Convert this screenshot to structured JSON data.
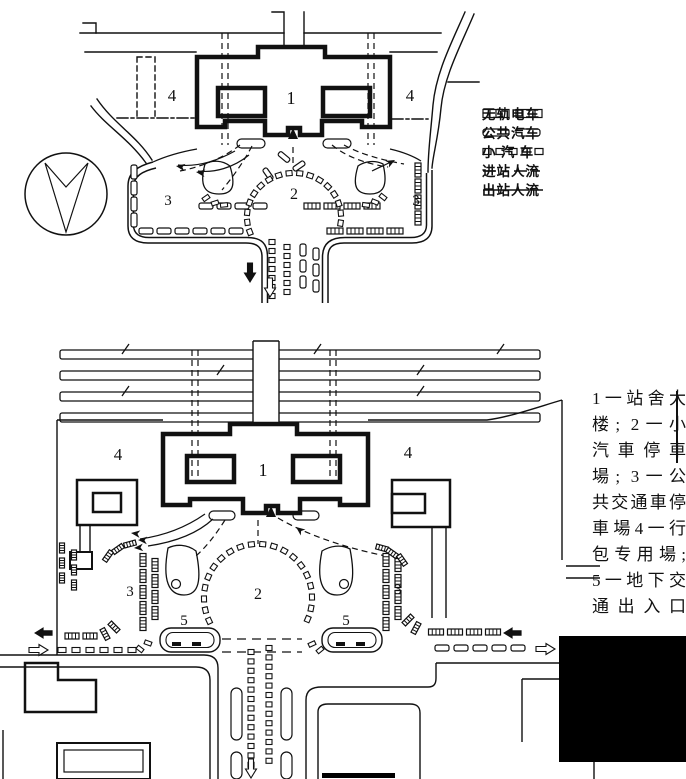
{
  "figure": {
    "type": "railway station forecourt site plans",
    "legend": {
      "items": [
        {
          "icon": "trolleybus-symbol",
          "label": "无轨电车"
        },
        {
          "icon": "bus-symbol",
          "label": "公共汽车"
        },
        {
          "icon": "car-symbol",
          "label": "小 汽 车"
        },
        {
          "icon": "dashed-flow-symbol",
          "label": "进站人流"
        },
        {
          "icon": "solid-flow-symbol",
          "label": "出站人流"
        }
      ]
    },
    "caption": {
      "text": "1一站舍大楼; 2一小汽車停車場; 3一公共交通車停車場4一行包专用場; 5一地下交通出入口",
      "lines": [
        "1一站舍大",
        "楼; 2一小",
        "汽車停車",
        "場; 3一公",
        "共交通車停",
        "車場4一行",
        "包专用場;",
        "5一地下交",
        "通出入口"
      ]
    },
    "top_plan": {
      "labels": {
        "station_building": "1",
        "car_park": "2",
        "transit_park_left": "3",
        "transit_park_right": "3",
        "baggage_left": "4",
        "baggage_right": "4"
      }
    },
    "bottom_plan": {
      "labels": {
        "station_building": "1",
        "car_park": "2",
        "transit_park_left": "3",
        "transit_park_right": "3",
        "baggage_left": "4",
        "baggage_right": "4",
        "underground_left": "5",
        "underground_right": "5"
      }
    }
  },
  "colors": {
    "ink": "#111111",
    "paper": "#ffffff"
  }
}
